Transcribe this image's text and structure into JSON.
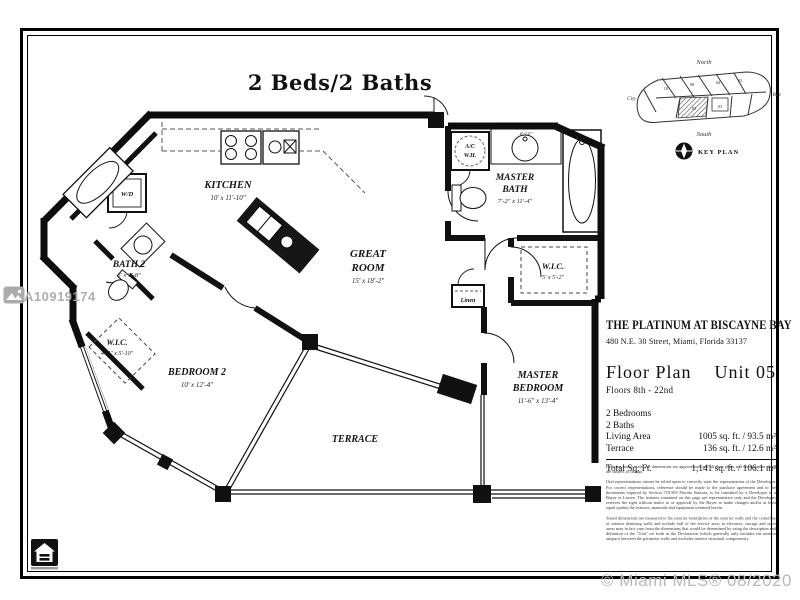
{
  "frame": {
    "title": "2 Beds/2 Baths"
  },
  "watermarks": {
    "listing_id": "A10919174",
    "mls_credit": "© Miami MLS® 08/2020"
  },
  "key_plan": {
    "north": "North",
    "south": "South",
    "city": "City",
    "bay": "Bay",
    "caption": "KEY PLAN",
    "units": [
      "10",
      "08",
      "04",
      "02",
      "05",
      "03"
    ]
  },
  "rooms": {
    "kitchen": {
      "name": "KITCHEN",
      "dim": "10' x 11'-10\""
    },
    "bath2": {
      "name": "BATH 2",
      "dim": "6' x 7'-8\""
    },
    "wic2": {
      "name": "W.I.C.",
      "dim": "4'-2\" x 5'-10\""
    },
    "bedroom2": {
      "name": "BEDROOM 2",
      "dim": "10' x 12'-4\""
    },
    "great_room": {
      "line1": "GREAT",
      "line2": "ROOM",
      "dim": "15' x 18'-2\""
    },
    "master_bath": {
      "line1": "MASTER",
      "line2": "BATH",
      "dim": "7'-2\" x 11'-4\""
    },
    "master_bedroom": {
      "line1": "MASTER",
      "line2": "BEDROOM",
      "dim": "11'-6\" x 13'-4\""
    },
    "wic_master": {
      "name": "W.I.C.",
      "dim": "5' x 5'-2\""
    },
    "terrace": {
      "name": "TERRACE"
    },
    "wd": {
      "name": "W/D"
    },
    "ac": {
      "line1": "A/C",
      "line2": "W.H."
    },
    "linen": {
      "name": "Linen"
    },
    "sink_dim": "6'-2.0\""
  },
  "info": {
    "building_name": "THE PLATINUM AT BISCAYNE BAY",
    "address": "480 N.E. 30 Street, Miami, Florida 33137",
    "plan_label": "Floor Plan",
    "unit_label": "Unit 05",
    "floors": "Floors 8th - 22nd",
    "stats_rows": [
      {
        "label": "2 Bedrooms",
        "value": ""
      },
      {
        "label": "2 Baths",
        "value": ""
      },
      {
        "label": "Living Area",
        "value": "1005 sq. ft. / 93.5 m²"
      },
      {
        "label": "Terrace",
        "value": "136 sq. ft. / 12.6 m²"
      }
    ],
    "total_row": {
      "label": "Total Sq. Ft.",
      "value": "1,141 sq. ft. / 106.1 m²"
    }
  },
  "disclaimer": {
    "p1": "Drawing not to scale. All dimensions are approximate and all floor plans and development plans are subject to change.",
    "p2": "Oral representations cannot be relied upon to correctly state the representation of the Developer. For correct representations, reference should be made to the purchase agreement and to the documents required by Section 718.503 Florida Statutes, to be furnished by a Developer to a Buyer or Lessee. The features contained on this page are representative only and the Developer reserves the right without notice to or approval by the Buyer to make changes and/or at least equal quality the features, materials and equipment itemized herein.",
    "p3": "Stated dimensions are measured to the exterior boundaries of the exterior walls and the centerline of interior demising walls and include half of the service area; in elevators, storage and sides areas may in fact vary from the dimensions that would be determined by using the description and definition of the \"Unit\" set forth in the Declaration (which generally only includes the interior airspace between the perimeter walls and excludes interior structural components)."
  }
}
